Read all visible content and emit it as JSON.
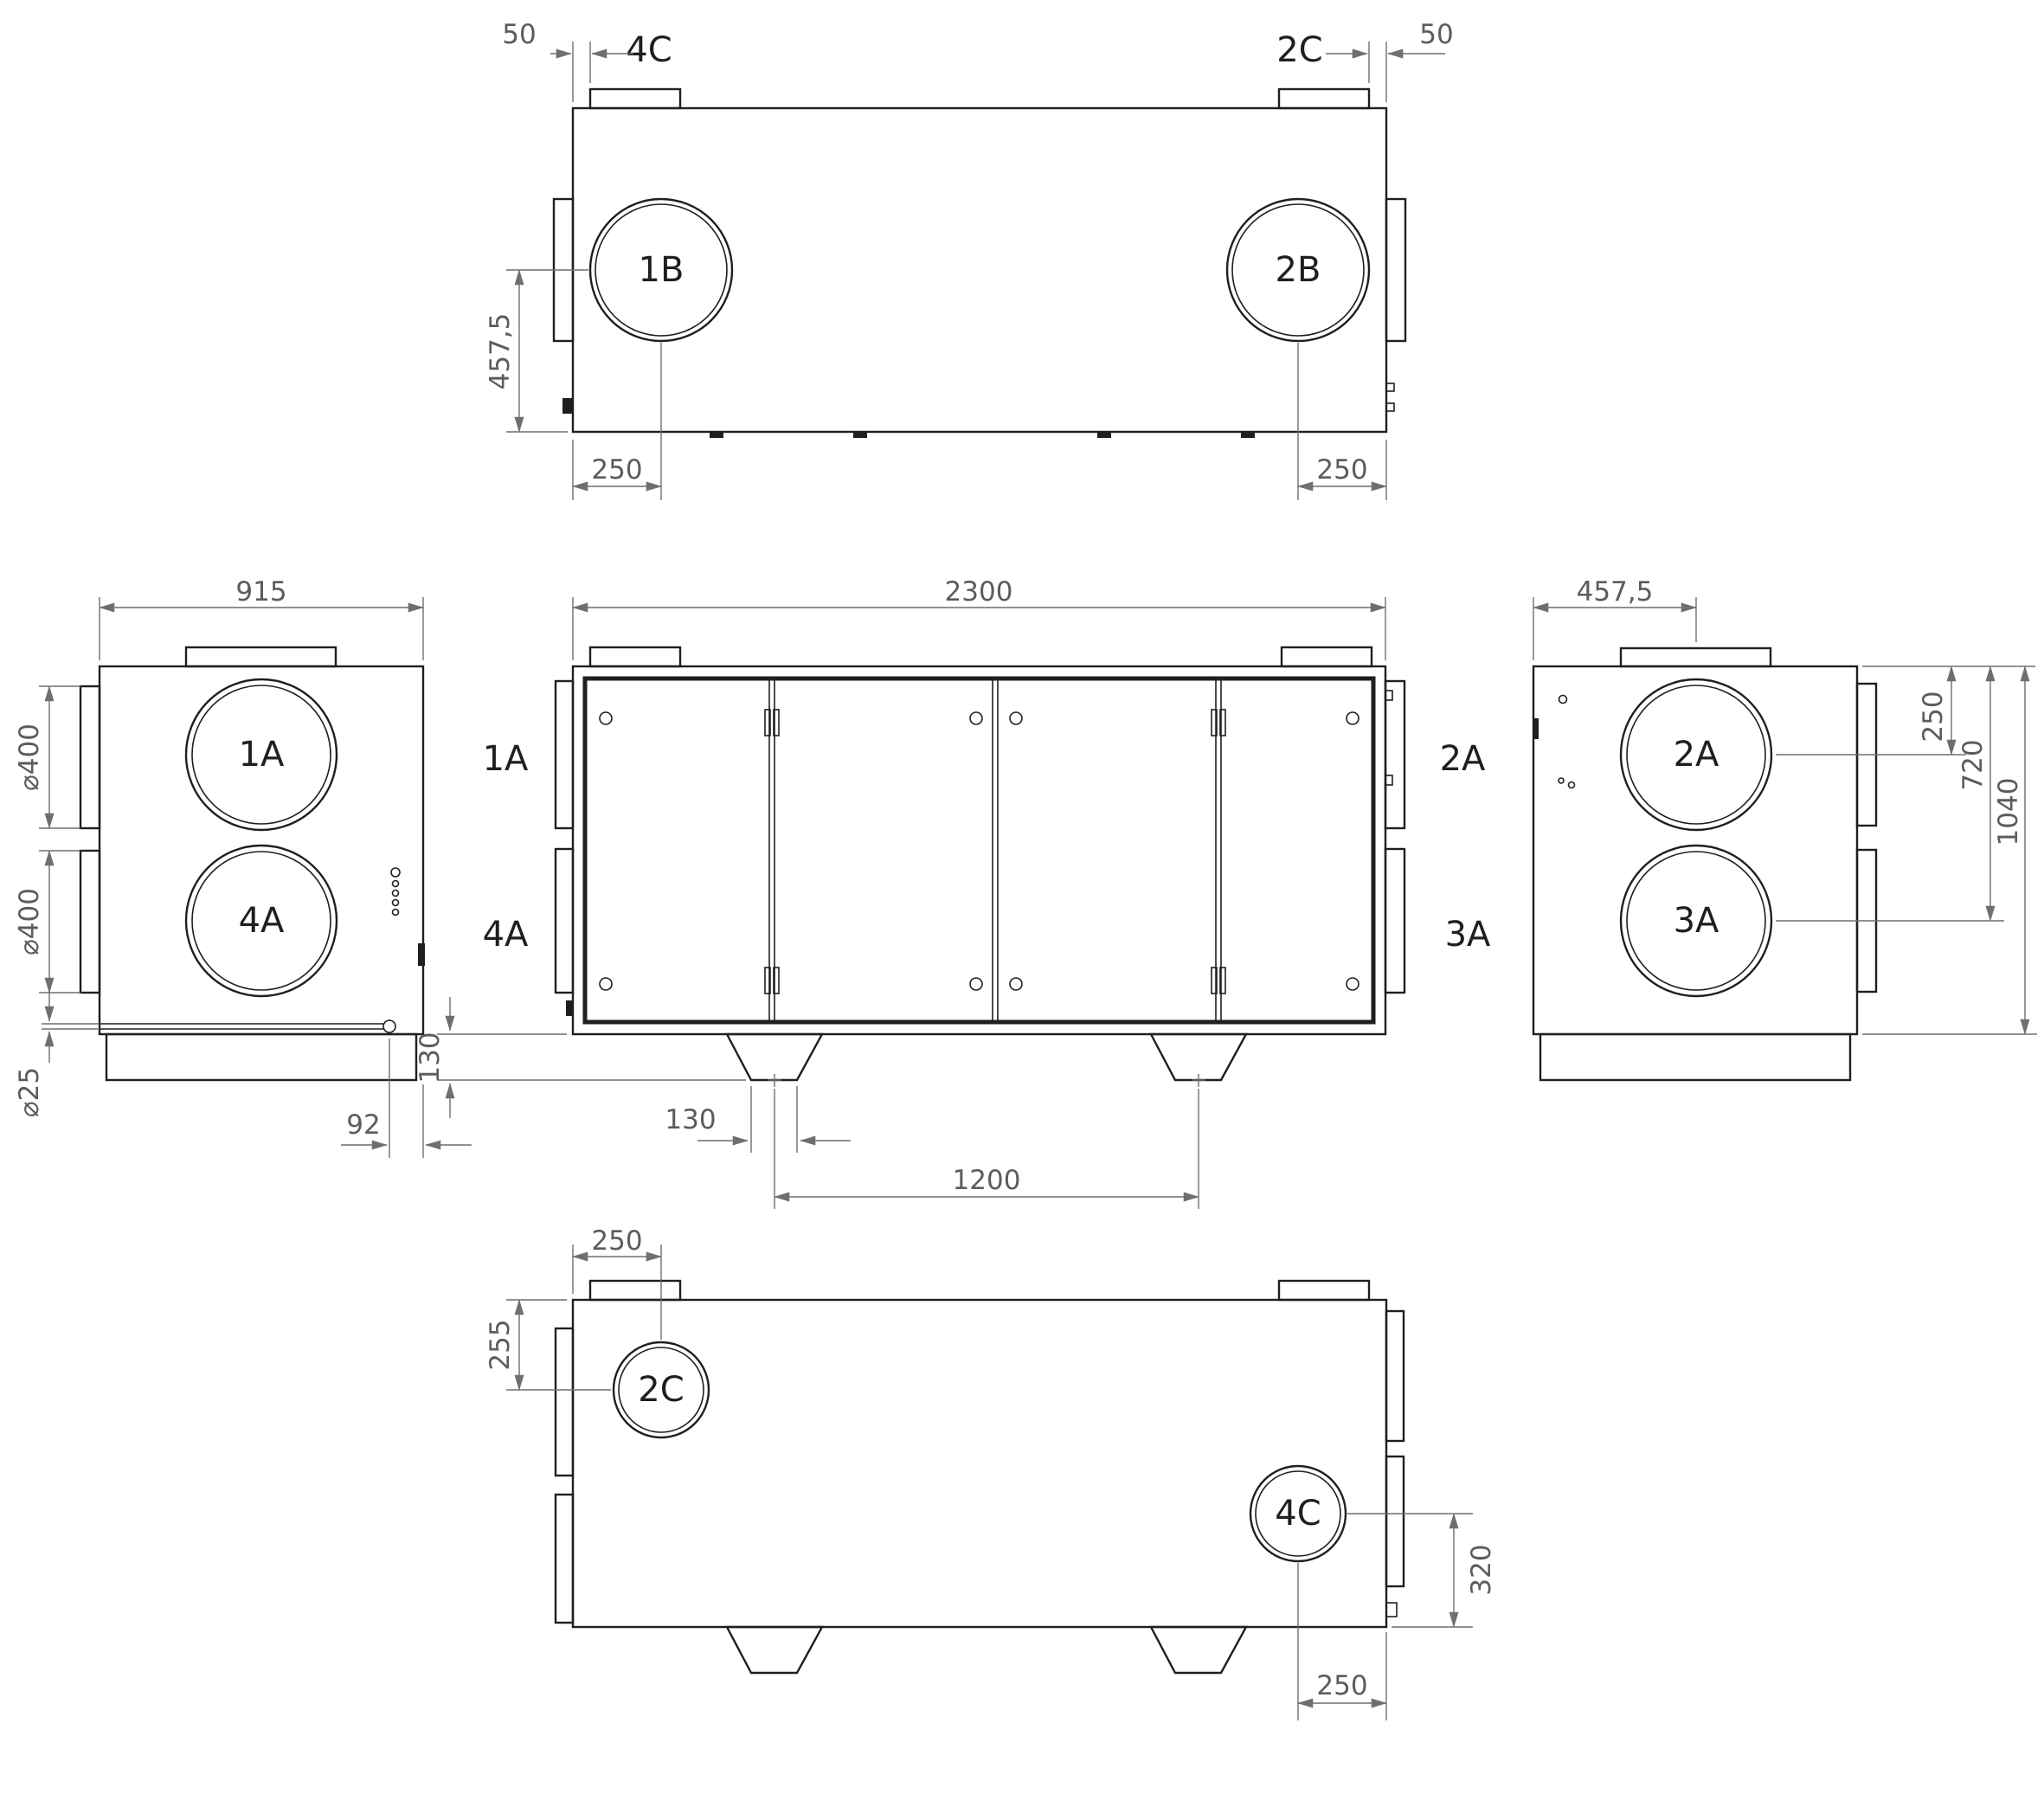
{
  "colors": {
    "ink": "#1f1f1f",
    "dim": "#6f6f6f",
    "dim-text": "#5c5c5c",
    "bg": "#ffffff"
  },
  "top_view": {
    "flange_left": "4C",
    "flange_right": "2C",
    "circle_left": "1B",
    "circle_right": "2B",
    "dim_offset_left": "50",
    "dim_offset_right": "50",
    "dim_depth_center": "457,5",
    "dim_port_left": "250",
    "dim_port_right": "250"
  },
  "left_view": {
    "circle_upper": "1A",
    "circle_lower": "4A",
    "dim_width": "915",
    "dim_dia_upper": "⌀400",
    "dim_dia_lower": "⌀400",
    "dim_dia_drain": "⌀25",
    "dim_drain_offset": "92"
  },
  "front_view": {
    "label_left_upper": "1A",
    "label_left_lower": "4A",
    "label_right_upper": "2A",
    "label_right_lower": "3A",
    "dim_length": "2300",
    "dim_foot_height": "130",
    "dim_foot_width": "130",
    "dim_foot_spacing": "1200"
  },
  "right_view": {
    "circle_upper": "2A",
    "circle_lower": "3A",
    "dim_depth_center": "457,5",
    "dim_to_upper": "250",
    "dim_to_lower": "720",
    "dim_height": "1040"
  },
  "bottom_view": {
    "circle_left": "2C",
    "circle_right": "4C",
    "dim_port_left_x": "250",
    "dim_port_left_y": "255",
    "dim_port_right_y": "320",
    "dim_port_right_x": "250"
  }
}
